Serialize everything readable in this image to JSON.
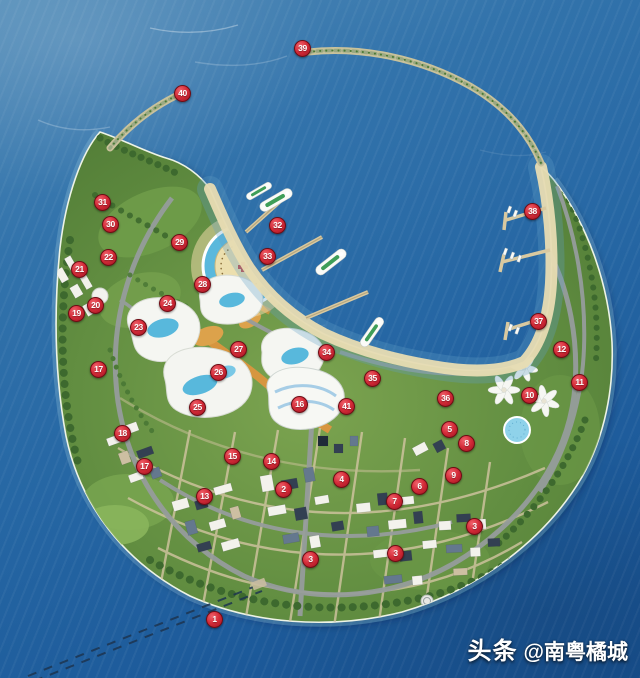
{
  "image": {
    "kind": "aerial-masterplan-rendering",
    "subject": "round artificial flower-shaped resort island with numbered plan markers, surrounded by sea"
  },
  "watermark": {
    "brand": "头条",
    "handle": "@南粤橘城"
  },
  "palette": {
    "ocean_light": "#528cb8",
    "ocean_deep": "#174f8e",
    "land_green": "#628e41",
    "sand": "#e8dcb2",
    "road_gray": "#969c9c",
    "pool_blue": "#58b8dc",
    "building_white": "#f3f2ec",
    "marker_red": "#d42b38",
    "marker_text": "#ffffff"
  },
  "map": {
    "markers": [
      {
        "n": "1",
        "x": 214,
        "y": 619
      },
      {
        "n": "2",
        "x": 283,
        "y": 489
      },
      {
        "n": "3",
        "x": 310,
        "y": 559
      },
      {
        "n": "3",
        "x": 395,
        "y": 553
      },
      {
        "n": "3",
        "x": 474,
        "y": 526
      },
      {
        "n": "4",
        "x": 341,
        "y": 479
      },
      {
        "n": "5",
        "x": 449,
        "y": 429
      },
      {
        "n": "6",
        "x": 419,
        "y": 486
      },
      {
        "n": "7",
        "x": 394,
        "y": 501
      },
      {
        "n": "8",
        "x": 466,
        "y": 443
      },
      {
        "n": "9",
        "x": 453,
        "y": 475
      },
      {
        "n": "10",
        "x": 529,
        "y": 395
      },
      {
        "n": "11",
        "x": 579,
        "y": 382
      },
      {
        "n": "12",
        "x": 561,
        "y": 349
      },
      {
        "n": "13",
        "x": 204,
        "y": 496
      },
      {
        "n": "14",
        "x": 271,
        "y": 461
      },
      {
        "n": "15",
        "x": 232,
        "y": 456
      },
      {
        "n": "16",
        "x": 299,
        "y": 404
      },
      {
        "n": "17",
        "x": 98,
        "y": 369
      },
      {
        "n": "17",
        "x": 144,
        "y": 466
      },
      {
        "n": "18",
        "x": 122,
        "y": 433
      },
      {
        "n": "19",
        "x": 76,
        "y": 313
      },
      {
        "n": "20",
        "x": 95,
        "y": 305
      },
      {
        "n": "21",
        "x": 79,
        "y": 269
      },
      {
        "n": "22",
        "x": 108,
        "y": 257
      },
      {
        "n": "23",
        "x": 138,
        "y": 327
      },
      {
        "n": "24",
        "x": 167,
        "y": 303
      },
      {
        "n": "25",
        "x": 197,
        "y": 407
      },
      {
        "n": "26",
        "x": 218,
        "y": 372
      },
      {
        "n": "27",
        "x": 238,
        "y": 349
      },
      {
        "n": "28",
        "x": 202,
        "y": 284
      },
      {
        "n": "29",
        "x": 179,
        "y": 242
      },
      {
        "n": "30",
        "x": 110,
        "y": 224
      },
      {
        "n": "31",
        "x": 102,
        "y": 202
      },
      {
        "n": "32",
        "x": 277,
        "y": 225
      },
      {
        "n": "33",
        "x": 267,
        "y": 256
      },
      {
        "n": "34",
        "x": 326,
        "y": 352
      },
      {
        "n": "35",
        "x": 372,
        "y": 378
      },
      {
        "n": "36",
        "x": 445,
        "y": 398
      },
      {
        "n": "37",
        "x": 538,
        "y": 321
      },
      {
        "n": "38",
        "x": 532,
        "y": 211
      },
      {
        "n": "39",
        "x": 302,
        "y": 48
      },
      {
        "n": "40",
        "x": 182,
        "y": 93
      },
      {
        "n": "41",
        "x": 346,
        "y": 406
      }
    ]
  }
}
